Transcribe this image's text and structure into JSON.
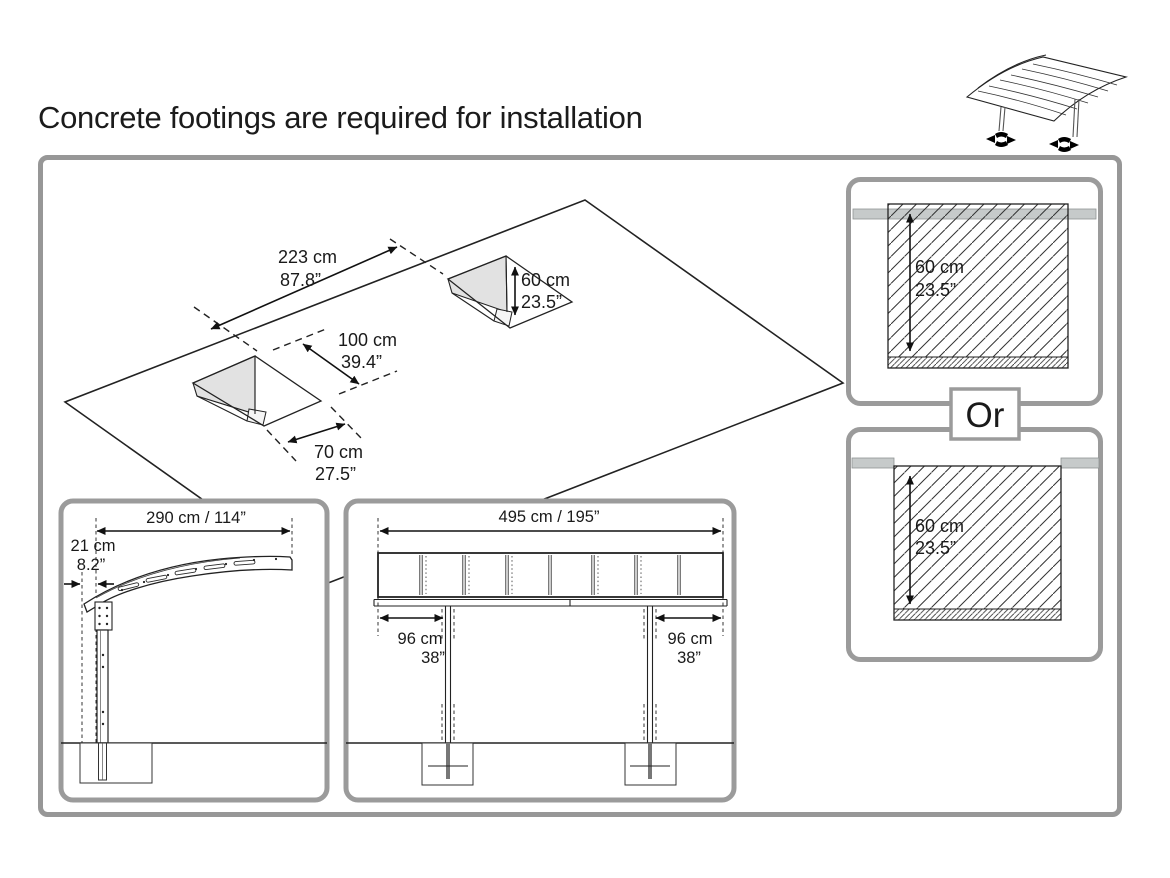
{
  "title": "Concrete footings are required for installation",
  "or_label": "Or",
  "plan_view": {
    "spacing": {
      "cm": "223 cm",
      "inch": "87.8”"
    },
    "hole_length": {
      "cm": "100 cm",
      "inch": "39.4”"
    },
    "hole_width": {
      "cm": "70 cm",
      "inch": "27.5”"
    },
    "hole_depth": {
      "cm": "60 cm",
      "inch": "23.5”"
    }
  },
  "cross_section_top": {
    "depth_cm": "60 cm",
    "depth_inch": "23.5”"
  },
  "cross_section_bottom": {
    "depth_cm": "60 cm",
    "depth_inch": "23.5”"
  },
  "side_view": {
    "span": "290 cm / 114”",
    "overhang_cm": "21 cm",
    "overhang_inch": "8.2”"
  },
  "front_view": {
    "span": "495 cm / 195”",
    "left_offset_cm": "96 cm",
    "left_offset_inch": "38”",
    "right_offset_cm": "96 cm",
    "right_offset_inch": "38”"
  }
}
